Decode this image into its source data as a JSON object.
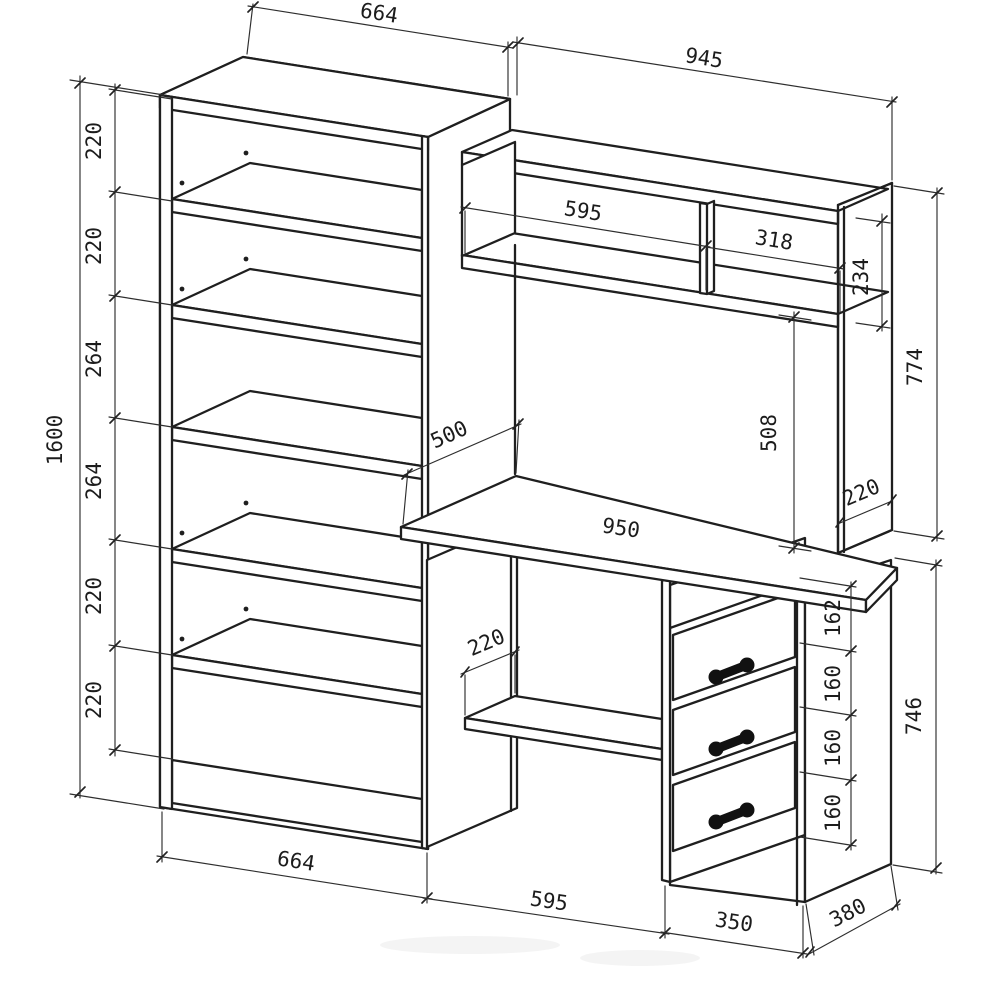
{
  "colors": {
    "background": "#ffffff",
    "line": "#1f1f1f"
  },
  "dims": {
    "bookshelf_top_width": "664",
    "bookshelf_bottom_width": "664",
    "bookshelf_height": "1600",
    "bookshelf_sections": [
      "220",
      "220",
      "264",
      "264",
      "220",
      "220"
    ],
    "desk_overall_width": "945",
    "hutch_left_shelf_width": "595",
    "hutch_right_shelf_width": "318",
    "hutch_niche_height": "234",
    "hutch_panel_height": "774",
    "hutch_panel_depth": "220",
    "shelf_to_desktop_height": "508",
    "desktop_width": "950",
    "desktop_depth": "500",
    "under_desk_shelf_depth": "220",
    "kneehole_width": "595",
    "drawer_top_gap": "162",
    "drawer_pitch": [
      "160",
      "160",
      "160"
    ],
    "drawer_unit_height": "746",
    "drawer_unit_width": "350",
    "drawer_unit_depth": "380"
  }
}
